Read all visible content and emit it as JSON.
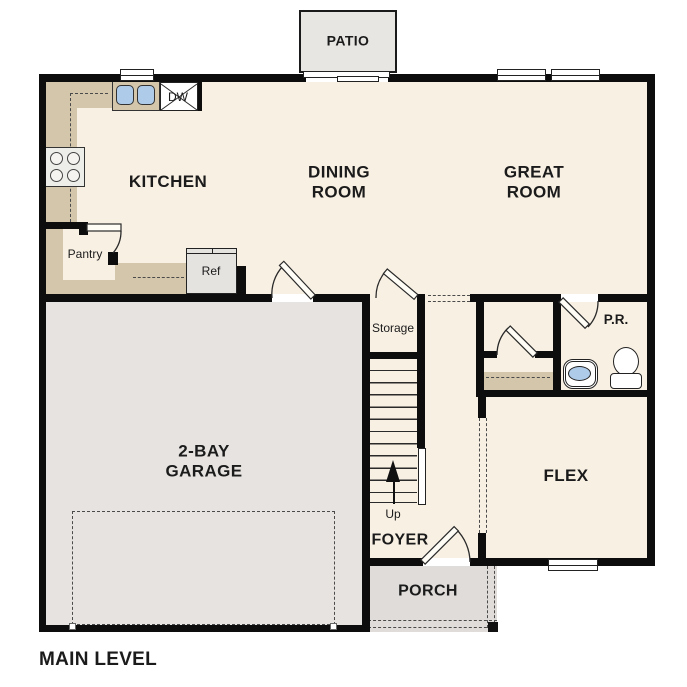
{
  "plan_title": "MAIN LEVEL",
  "rooms": {
    "patio": "PATIO",
    "kitchen": "KITCHEN",
    "dining_room": "DINING\nROOM",
    "great_room": "GREAT\nROOM",
    "pantry": "Pantry",
    "storage": "Storage",
    "powder_room": "P.R.",
    "garage": "2-BAY\nGARAGE",
    "flex": "FLEX",
    "foyer": "FOYER",
    "porch": "PORCH"
  },
  "fixtures": {
    "dishwasher": "DW",
    "refrigerator": "Ref",
    "stairs_up": "Up"
  },
  "colors": {
    "floor": "#f8f0e3",
    "garage": "#e6e3e0",
    "porch": "#dfdcd9",
    "patio": "#e8e6e3",
    "counter": "#d3c6ab",
    "blue": "#aecbe9",
    "wall": "#0d0d0d",
    "line": "#2a2a2a"
  }
}
